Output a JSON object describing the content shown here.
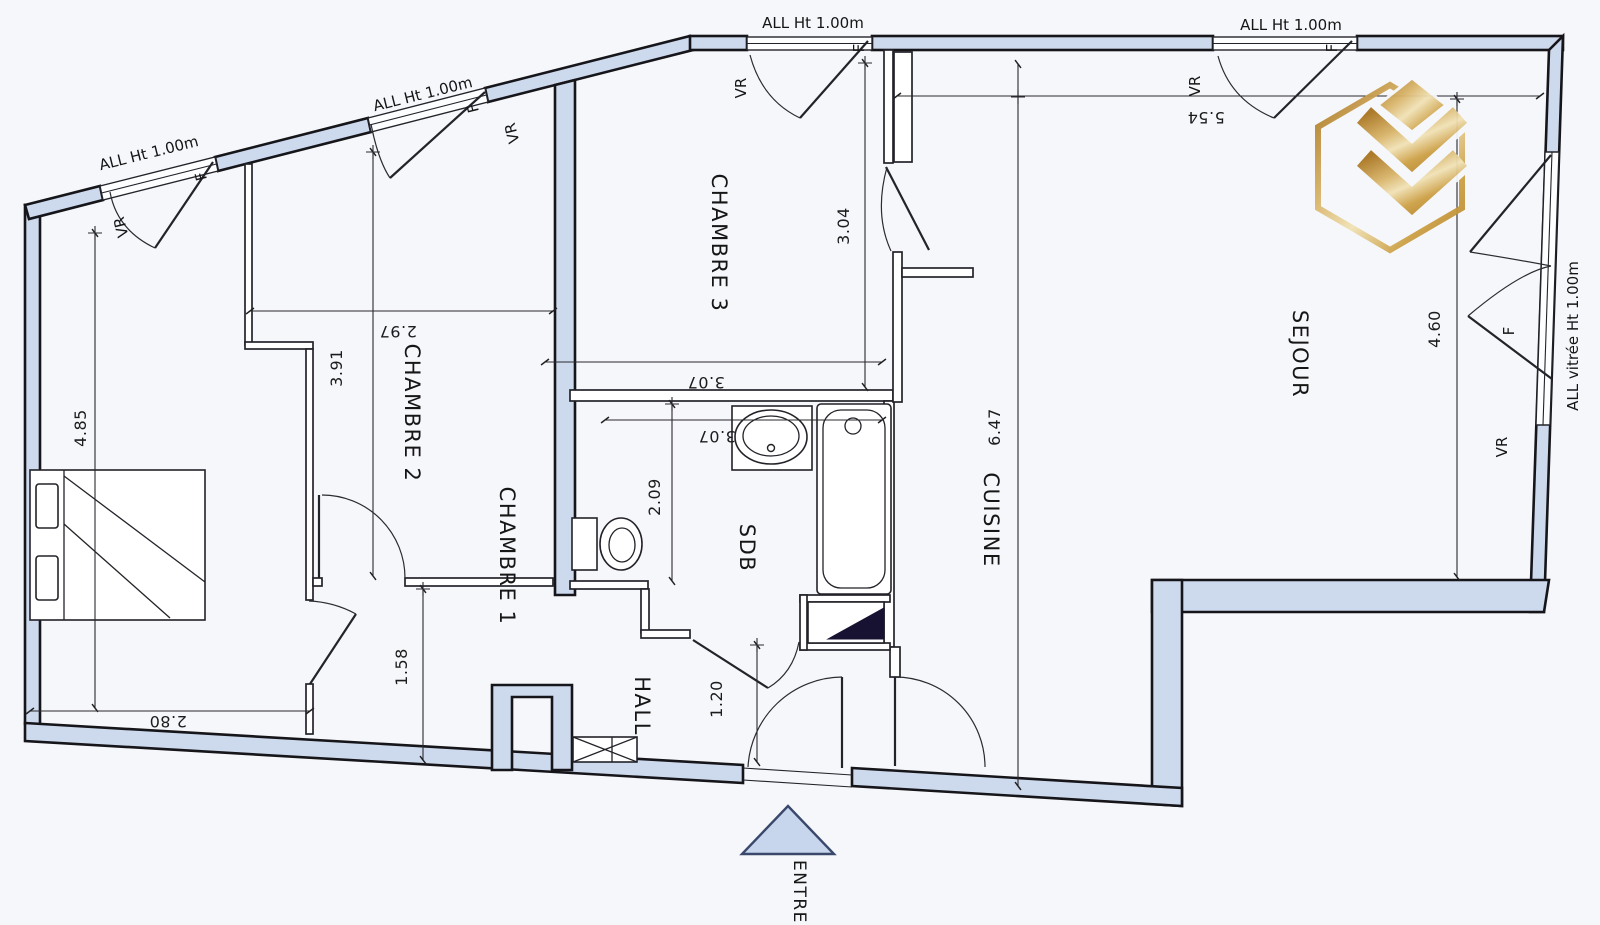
{
  "plan": {
    "rooms": {
      "chambre1": "CHAMBRE 1",
      "chambre2": "CHAMBRE 2",
      "chambre3": "CHAMBRE 3",
      "sdb": "SDB",
      "hall": "HALL",
      "cuisine": "CUISINE",
      "sejour": "SEJOUR"
    },
    "entrance": "ENTREE",
    "labels": {
      "allege": "ALL Ht 1.00m",
      "glazed": "ALL vitrée Ht 1.00m",
      "shutter": "VR",
      "window": "F"
    },
    "dimensions": {
      "chambre1_length": "4.85",
      "chambre1_width": "2.80",
      "chambre2_length": "3.91",
      "chambre2_width": "2.97",
      "chambre3_length": "3.04",
      "chambre3_width": "3.07",
      "sdb_width": "3.07",
      "sdb_depth": "2.09",
      "hall_width": "1.58",
      "entry_width": "1.20",
      "cuisine_length": "6.47",
      "sejour_width": "5.54",
      "sejour_length": "4.60"
    }
  }
}
